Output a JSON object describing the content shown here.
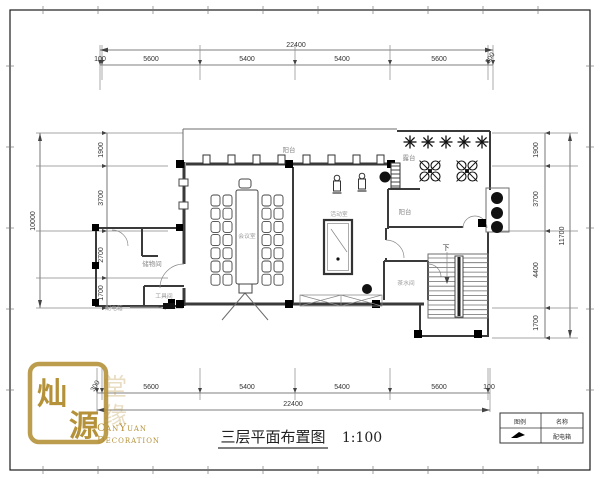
{
  "sheet": {
    "background": "#ffffff",
    "line_color": "#3a3a3a",
    "gold_color": "#b5923a"
  },
  "title": {
    "text": "三层平面布置图",
    "scale": "1:100"
  },
  "logo": {
    "seal_char_1": "灿",
    "seal_char_2": "源",
    "watermark_char_1": "堂",
    "watermark_char_2": "缘",
    "name_line1": "CanYuan",
    "name_line2": "Decoration"
  },
  "legend": {
    "header_symbol": "图例",
    "header_name": "名称",
    "row_name": "配电箱"
  },
  "dimensions": {
    "top": {
      "total": "22400",
      "segments": [
        "100",
        "5600",
        "5400",
        "5400",
        "5600",
        "300"
      ]
    },
    "bottom": {
      "total": "22400",
      "segments": [
        "300",
        "5600",
        "5400",
        "5400",
        "5600",
        "100"
      ]
    },
    "left": {
      "total": "10000",
      "segments": [
        "1900",
        "3700",
        "2700",
        "1700"
      ]
    },
    "right": {
      "total": "11700",
      "segments": [
        "1900",
        "3700",
        "4400",
        "1700"
      ]
    }
  },
  "rooms": {
    "balcony_top": "阳台",
    "terrace": "露台",
    "balcony_right": "阳台",
    "meeting": "会议室",
    "activity": "活动室",
    "storage": "储物间",
    "tool": "工具间",
    "tea": "茶水间",
    "distribution_box": "配电箱",
    "stairs_down": "下"
  }
}
